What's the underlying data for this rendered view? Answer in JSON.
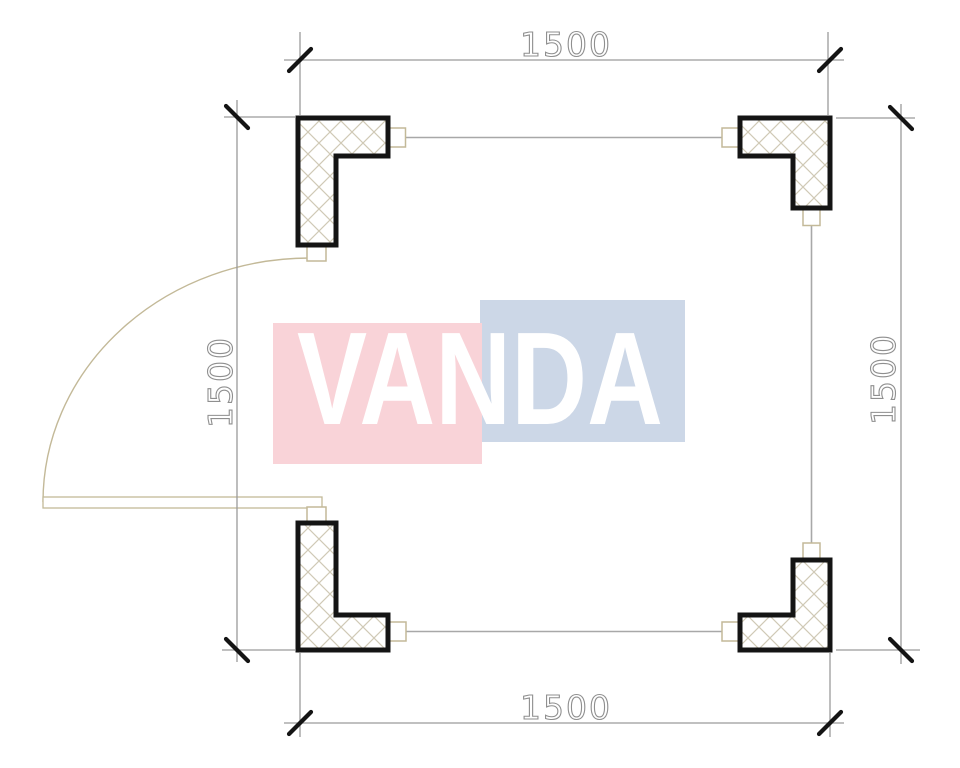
{
  "drawing": {
    "kind": "floor-plan",
    "plan_shape": "square",
    "corner_columns": 4,
    "walls": {
      "top": "window",
      "right": "window",
      "bottom": "window",
      "left": "door-with-swing"
    }
  },
  "dimensions": {
    "top_label": "1500",
    "bottom_label": "1500",
    "left_label": "1500",
    "right_label": "1500"
  },
  "watermark": {
    "text": "VANDA",
    "pink_color": "#f9d3d8",
    "blue_color": "#ccd7e7",
    "text_color": "#ffffff"
  },
  "colors": {
    "column_outline": "#141414",
    "hatch_line": "#d0c9b6",
    "stub_and_door": "#c3b998",
    "window_line": "#a8a8a8",
    "dimension_line": "#9a9a9a",
    "dimension_tick": "#141414",
    "dimension_text": "#8f8f8f",
    "background": "#ffffff"
  }
}
